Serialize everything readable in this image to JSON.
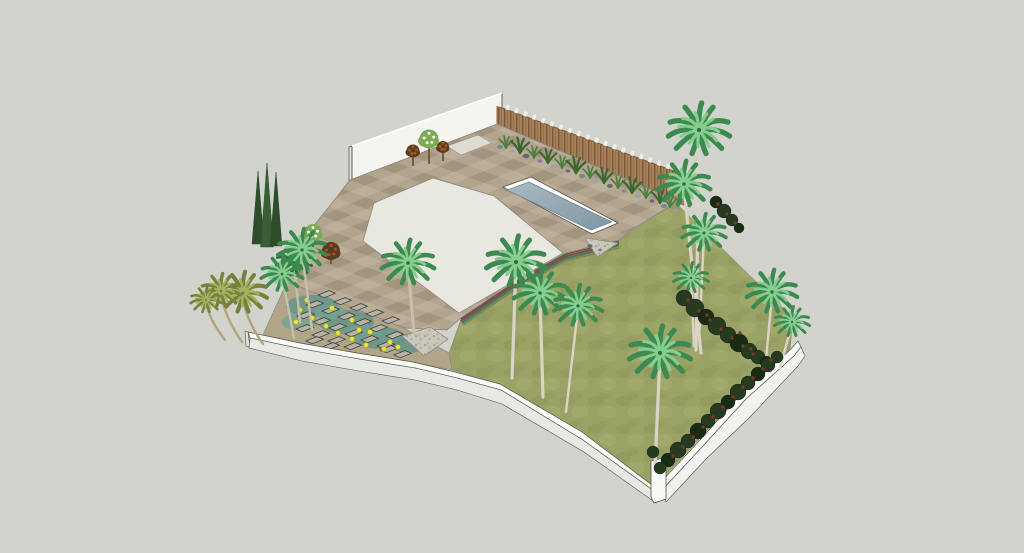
{
  "scene": {
    "title": "Aerial 3D render of a residential garden landscape design with swimming pool, paved patio, lawn and palm trees",
    "view": "isometric aerial perspective",
    "canvas": {
      "width": 1024,
      "height": 553
    }
  },
  "elements": {
    "rear_wall": "white rendered boundary wall",
    "privacy_fence": "timber slat privacy fence with light post caps",
    "fence_border": "gravel strip with boulders and ornamental grasses",
    "pool": "rectangular swimming pool with white coping",
    "patio": "chequered stone patio paving",
    "terrace": "smooth light concrete terrace",
    "lawn": "textured green lawn",
    "stepping_path": "stepping-stone path through teal groundcover with yellow flowers",
    "retaining_edge": "multicoloured layered retaining edge",
    "gravel_pads": "triangular gravel pads",
    "front_wall": "curved white perimeter wall",
    "right_wall": "straight white perimeter wall with corner post",
    "planting": "palm trees, italian cypresses, flowering shrubs, climbing red-flowered hedge"
  },
  "palette": {
    "bg": "#d2d3cc",
    "line": "#54534c",
    "line-soft": "#87857a",
    "shadow": "#a9aaa1",
    "wall-face": "#f4f4f0",
    "wall-end": "#e2e2dd",
    "wall-top": "#fafaf7",
    "wall-face2": "#e9e9e4",
    "wall-face3": "#f1f1ed",
    "post-white": "#f8f8f5",
    "fence-a": "#a5805a",
    "fence-dark": "#7b5a38",
    "fence-cap": "#efeee7",
    "pave-a": "#b2a48f",
    "pave-b": "#a3947e",
    "pave-c": "#bcae99",
    "inset": "#dedcd2",
    "terrace": "#e8e7e0",
    "gravel-a": "#ccc7bc",
    "gravel-b": "#aaa499",
    "gravel-c": "#b8b2a6",
    "water-1": "#a9bac3",
    "water-2": "#8096a4",
    "pool-coping": "#ffffff",
    "pool-edge": "#6c8191",
    "grass-a": "#9ba266",
    "grass-b": "#8d9459",
    "grass-c": "#a8ae72",
    "teal-base": "#b0a489",
    "teal-moss": "#5e948b",
    "teal-moss2": "#74a392",
    "stone": "#b7b3a6",
    "stone-edge": "#43423a",
    "flower": "#e9e33b",
    "flower-edge": "#b6b011",
    "trunk": "#c6bfab",
    "trunk-light": "#d9d4c5",
    "trunk-olive": "#b1a47e",
    "palm-dark": "#3c8a50",
    "palm-light": "#86cd90",
    "palm-deep": "#2d6f40",
    "olive-dark": "#75823c",
    "olive-light": "#a7b161",
    "cy-a": "#2e4d2b",
    "cy-b": "#3a5d35",
    "hedge": "#263a20",
    "hedge-deep": "#192b15",
    "hedge-red": "#7e352a",
    "tuft": "#4f7f3e",
    "tuft-dark": "#3c6730",
    "rock-a": "#788494",
    "rock-b": "#98a1ac",
    "rock-c": "#616b78",
    "maroon": "#5e3a1c",
    "maroon-dot": "#9c5a2a",
    "leaf-green": "#7cab55",
    "bloom-white": "#f2f6e8",
    "edge-red": "#8a4a3c",
    "edge-teal": "#417a74",
    "edge-olive": "#7d8a4b",
    "branch": "#6b4a2a"
  },
  "vegetation": {
    "palms": [
      {
        "x": 408,
        "y": 263,
        "r": 24,
        "tx": 414,
        "ty": 333
      },
      {
        "x": 294,
        "y": 262,
        "r": 16,
        "tx": 300,
        "ty": 322,
        "d": "palm-deep",
        "l": "palm-dark"
      },
      {
        "x": 302,
        "y": 250,
        "r": 22,
        "tx": 312,
        "ty": 330
      },
      {
        "x": 282,
        "y": 274,
        "r": 19,
        "tx": 294,
        "ty": 338
      },
      {
        "x": 243,
        "y": 293,
        "r": 22,
        "tx": 263,
        "ty": 344,
        "d": "olive-dark",
        "l": "olive-light",
        "t": "trunk-olive",
        "lean": -8
      },
      {
        "x": 221,
        "y": 291,
        "r": 18,
        "tx": 242,
        "ty": 342,
        "d": "olive-dark",
        "l": "olive-light",
        "t": "trunk-olive",
        "lean": -7
      },
      {
        "x": 206,
        "y": 300,
        "r": 14,
        "tx": 225,
        "ty": 340,
        "d": "olive-dark",
        "l": "olive-light",
        "t": "trunk-olive",
        "lean": -6
      },
      {
        "x": 516,
        "y": 262,
        "r": 27,
        "tx": 512,
        "ty": 378,
        "t": "trunk-light"
      },
      {
        "x": 540,
        "y": 293,
        "r": 24,
        "tx": 543,
        "ty": 397,
        "t": "trunk-light"
      },
      {
        "x": 578,
        "y": 306,
        "r": 22,
        "tx": 566,
        "ty": 412,
        "t": "trunk-light"
      },
      {
        "x": 699,
        "y": 130,
        "r": 28,
        "tx": 696,
        "ty": 350,
        "t": "trunk-light"
      },
      {
        "x": 684,
        "y": 184,
        "r": 24,
        "tx": 701,
        "ty": 353,
        "t": "trunk-light"
      },
      {
        "x": 704,
        "y": 233,
        "r": 20,
        "tx": 699,
        "ty": 340,
        "t": "trunk-light"
      },
      {
        "x": 691,
        "y": 278,
        "r": 16,
        "tx": 694,
        "ty": 346,
        "t": "trunk-light"
      },
      {
        "x": 772,
        "y": 292,
        "r": 23,
        "tx": 766,
        "ty": 360,
        "t": "trunk-light"
      },
      {
        "x": 792,
        "y": 322,
        "r": 16,
        "tx": 780,
        "ty": 368,
        "t": "trunk-light"
      },
      {
        "x": 660,
        "y": 353,
        "r": 28,
        "tx": 655,
        "ty": 466,
        "t": "trunk-light"
      }
    ],
    "cypresses": [
      {
        "x": 258,
        "tip": 171,
        "base": 244,
        "w": 6,
        "f": "cy-a"
      },
      {
        "x": 267,
        "tip": 163,
        "base": 247,
        "w": 6.5,
        "f": "cy-b"
      },
      {
        "x": 276,
        "tip": 172,
        "base": 246,
        "w": 6,
        "f": "cy-a"
      }
    ],
    "shrubs": [
      {
        "x": 413,
        "y": 151,
        "r": 6.5,
        "ty": 166,
        "type": "maroon"
      },
      {
        "x": 429,
        "y": 139,
        "r": 9.5,
        "ty": 164,
        "type": "bloom"
      },
      {
        "x": 443,
        "y": 147,
        "r": 6,
        "ty": 161,
        "type": "maroon"
      },
      {
        "x": 313,
        "y": 233,
        "r": 9,
        "ty": 247,
        "type": "bloom"
      },
      {
        "x": 331,
        "y": 251,
        "r": 9,
        "ty": 264,
        "type": "maroon"
      }
    ],
    "tufts": [
      {
        "x": 506,
        "y": 148,
        "s": 1
      },
      {
        "x": 520,
        "y": 153,
        "s": 1.3,
        "d": 1
      },
      {
        "x": 534,
        "y": 158,
        "s": 1
      },
      {
        "x": 548,
        "y": 163,
        "s": 1.2,
        "d": 1
      },
      {
        "x": 562,
        "y": 168,
        "s": 1
      },
      {
        "x": 576,
        "y": 173,
        "s": 1.35,
        "d": 1
      },
      {
        "x": 590,
        "y": 178,
        "s": 1
      },
      {
        "x": 604,
        "y": 183,
        "s": 1.25,
        "d": 1
      },
      {
        "x": 618,
        "y": 188,
        "s": 1
      },
      {
        "x": 632,
        "y": 193,
        "s": 1.3,
        "d": 1
      },
      {
        "x": 646,
        "y": 198,
        "s": 1
      },
      {
        "x": 660,
        "y": 203,
        "s": 1.2,
        "d": 1
      },
      {
        "x": 670,
        "y": 207,
        "s": 1
      }
    ],
    "rocks": [
      {
        "x": 500,
        "y": 147,
        "rx": 3
      },
      {
        "x": 512,
        "y": 151,
        "rx": 2.2
      },
      {
        "x": 526,
        "y": 156,
        "rx": 3.4
      },
      {
        "x": 540,
        "y": 161,
        "rx": 2.4
      },
      {
        "x": 554,
        "y": 166,
        "rx": 3
      },
      {
        "x": 568,
        "y": 171,
        "rx": 2.2
      },
      {
        "x": 582,
        "y": 176,
        "rx": 3.2
      },
      {
        "x": 596,
        "y": 181,
        "rx": 2.4
      },
      {
        "x": 610,
        "y": 186,
        "rx": 3
      },
      {
        "x": 624,
        "y": 191,
        "rx": 2.2
      },
      {
        "x": 638,
        "y": 196,
        "rx": 3.3
      },
      {
        "x": 652,
        "y": 201,
        "rx": 2.4
      },
      {
        "x": 664,
        "y": 206,
        "rx": 3
      },
      {
        "x": 676,
        "y": 210,
        "rx": 2.2
      },
      {
        "x": 590,
        "y": 246,
        "rx": 2.6
      },
      {
        "x": 600,
        "y": 250,
        "rx": 2
      }
    ],
    "hedge": [
      {
        "x": 716,
        "y": 202,
        "r": 6
      },
      {
        "x": 724,
        "y": 211,
        "r": 7
      },
      {
        "x": 732,
        "y": 220,
        "r": 6
      },
      {
        "x": 739,
        "y": 228,
        "r": 5
      },
      {
        "x": 684,
        "y": 298,
        "r": 8
      },
      {
        "x": 695,
        "y": 308,
        "r": 9
      },
      {
        "x": 706,
        "y": 317,
        "r": 8
      },
      {
        "x": 717,
        "y": 326,
        "r": 9
      },
      {
        "x": 728,
        "y": 335,
        "r": 8
      },
      {
        "x": 739,
        "y": 343,
        "r": 9
      },
      {
        "x": 749,
        "y": 351,
        "r": 8
      },
      {
        "x": 758,
        "y": 357,
        "r": 7
      },
      {
        "x": 766,
        "y": 362,
        "r": 6
      },
      {
        "x": 777,
        "y": 357,
        "r": 6
      },
      {
        "x": 768,
        "y": 365,
        "r": 7
      },
      {
        "x": 758,
        "y": 374,
        "r": 7
      },
      {
        "x": 748,
        "y": 383,
        "r": 7
      },
      {
        "x": 738,
        "y": 392,
        "r": 8
      },
      {
        "x": 728,
        "y": 402,
        "r": 7
      },
      {
        "x": 718,
        "y": 411,
        "r": 8
      },
      {
        "x": 708,
        "y": 421,
        "r": 7
      },
      {
        "x": 698,
        "y": 431,
        "r": 8
      },
      {
        "x": 688,
        "y": 441,
        "r": 7
      },
      {
        "x": 678,
        "y": 450,
        "r": 8
      },
      {
        "x": 668,
        "y": 460,
        "r": 7
      },
      {
        "x": 660,
        "y": 468,
        "r": 6
      },
      {
        "x": 653,
        "y": 452,
        "r": 6
      }
    ],
    "hedge_reds": [
      [
        718,
        204
      ],
      [
        727,
        214
      ],
      [
        735,
        223
      ],
      [
        688,
        300
      ],
      [
        699,
        311
      ],
      [
        710,
        320
      ],
      [
        721,
        329
      ],
      [
        732,
        338
      ],
      [
        743,
        346
      ],
      [
        753,
        354
      ],
      [
        771,
        360
      ],
      [
        763,
        369
      ],
      [
        753,
        378
      ],
      [
        743,
        387
      ],
      [
        733,
        397
      ],
      [
        723,
        407
      ],
      [
        713,
        417
      ],
      [
        703,
        427
      ],
      [
        693,
        437
      ],
      [
        683,
        447
      ],
      [
        673,
        456
      ],
      [
        740,
        333
      ],
      [
        707,
        315
      ],
      [
        751,
        349
      ]
    ]
  },
  "groundcover": {
    "patches": [
      {
        "x": 312,
        "y": 306,
        "rx": 26,
        "ry": 11,
        "c": "teal-moss"
      },
      {
        "x": 346,
        "y": 322,
        "rx": 28,
        "ry": 12,
        "c": "teal-moss"
      },
      {
        "x": 380,
        "y": 338,
        "rx": 26,
        "ry": 11,
        "c": "teal-moss"
      },
      {
        "x": 300,
        "y": 322,
        "rx": 18,
        "ry": 9,
        "c": "teal-moss2"
      },
      {
        "x": 408,
        "y": 346,
        "rx": 16,
        "ry": 7,
        "c": "teal-moss"
      },
      {
        "x": 330,
        "y": 312,
        "rx": 16,
        "ry": 7,
        "c": "teal-moss2"
      },
      {
        "x": 364,
        "y": 333,
        "rx": 18,
        "ry": 8,
        "c": "teal-moss2"
      }
    ],
    "stones": [
      [
        318,
        295
      ],
      [
        334,
        302
      ],
      [
        350,
        308
      ],
      [
        366,
        314
      ],
      [
        382,
        321
      ],
      [
        306,
        305
      ],
      [
        322,
        311
      ],
      [
        338,
        317
      ],
      [
        354,
        323
      ],
      [
        370,
        329
      ],
      [
        386,
        336
      ],
      [
        297,
        316
      ],
      [
        313,
        322
      ],
      [
        329,
        328
      ],
      [
        345,
        334
      ],
      [
        361,
        340
      ],
      [
        377,
        346
      ],
      [
        296,
        329
      ],
      [
        312,
        335
      ],
      [
        328,
        341
      ],
      [
        344,
        347
      ],
      [
        306,
        341
      ],
      [
        322,
        347
      ],
      [
        380,
        350
      ],
      [
        394,
        355
      ]
    ],
    "flowers": [
      [
        300,
        310
      ],
      [
        312,
        318
      ],
      [
        326,
        326
      ],
      [
        338,
        333
      ],
      [
        352,
        339
      ],
      [
        366,
        345
      ],
      [
        384,
        349
      ],
      [
        332,
        308
      ],
      [
        352,
        320
      ],
      [
        370,
        332
      ],
      [
        390,
        342
      ],
      [
        296,
        322
      ],
      [
        344,
        352
      ],
      [
        398,
        347
      ],
      [
        307,
        300
      ],
      [
        359,
        330
      ]
    ]
  }
}
